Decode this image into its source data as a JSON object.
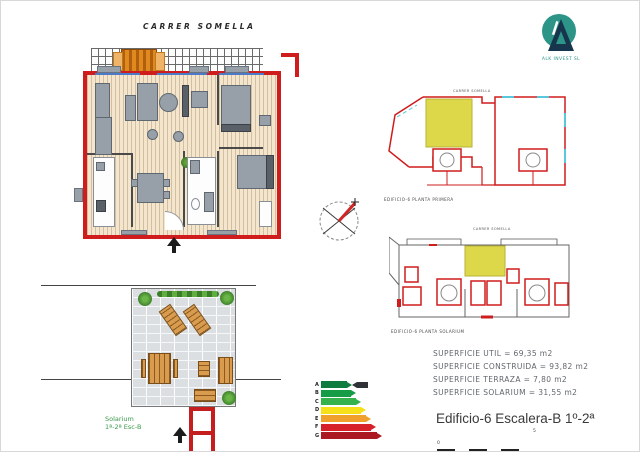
{
  "header": {
    "street_label": "CARRER SOMELLA"
  },
  "logo": {
    "company": "ALK INVEST SL",
    "circle_color": "#2d9488",
    "triangle_color": "#17364d"
  },
  "main_plan": {
    "wall_color": "#cf1d1d",
    "floor_color": "#f3e6cd",
    "window_color": "#4a7ac8"
  },
  "compass": {
    "needle_color": "#d12626"
  },
  "site_plan_upper": {
    "street_label": "CARRER SOMELLA",
    "caption": "EDIFICIO-6 PLANTA PRIMERA",
    "highlight_color": "#ddd84a"
  },
  "site_plan_lower": {
    "street_label": "CARRER SOMELLA",
    "caption": "EDIFICIO-6 PLANTA SOLARIUM",
    "highlight_color": "#ddd84a"
  },
  "solarium": {
    "label_line1": "Solarium",
    "label_line2": "1ª-2ª Esc-B"
  },
  "energy": {
    "rows": [
      {
        "letter": "A",
        "color": "#0e7c3f",
        "width": 26
      },
      {
        "letter": "B",
        "color": "#169c46",
        "width": 30
      },
      {
        "letter": "C",
        "color": "#35b24b",
        "width": 35
      },
      {
        "letter": "D",
        "color": "#f5e019",
        "width": 40
      },
      {
        "letter": "E",
        "color": "#efa12c",
        "width": 45
      },
      {
        "letter": "F",
        "color": "#d6202a",
        "width": 50
      },
      {
        "letter": "G",
        "color": "#ab1a22",
        "width": 56
      }
    ]
  },
  "surfaces": {
    "lines": [
      "SUPERFICIE UTIL = 69,35 m2",
      "SUPERFICIE CONSTRUIDA = 93,82 m2",
      "SUPERFICIE TERRAZA = 7,80 m2",
      "SUPERFICIE SOLARIUM = 31,55 m2"
    ]
  },
  "title_block": {
    "title": "Edificio-6 Escalera-B 1º-2ª",
    "scale_start": "0",
    "scale_end": "5"
  }
}
